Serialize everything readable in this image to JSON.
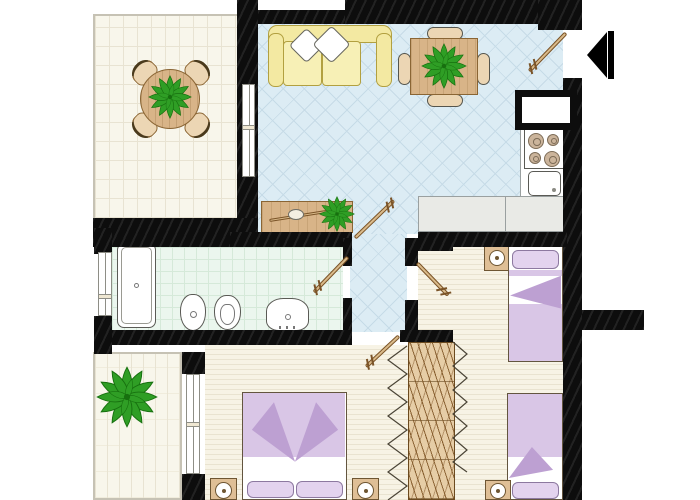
{
  "title": "Apartment floor plan (no text labels in drawing)",
  "palette": {
    "wall": "#0d0d0d",
    "livingFloor": "#dcecf4",
    "livingLine": "#c6dbe7",
    "tileFloor": "#f8f6eb",
    "tileLine": "#e8e3d2",
    "bathFloor": "#ebf6ee",
    "bathLine": "#d5e9d9",
    "woodFloor": "#f7f3e5",
    "woodLine": "#e9e3d0",
    "wood": "#d8b488",
    "woodDark": "#8a6534",
    "chairWood": "#ecd6b4",
    "sofa": "#f3e9a2",
    "sofaBorder": "#b2a040",
    "sofaCushion": "#f7f0b6",
    "bedFill": "#d9c6e6",
    "bedDark": "#bda0d2",
    "bedPillow": "#e3d3ee",
    "bedSheet": "#ffffff",
    "counter": "#e9eae6",
    "counterBorder": "#9aa0a0",
    "plantDark": "#17700f",
    "plantMid": "#2f9e25",
    "plantLight": "#54c23c",
    "leaf": "#d9ba8a",
    "leafBorder": "#7a5327",
    "fixture": "#ffffff",
    "fixtureBorder": "#5a5a55",
    "windowBorder": "#8e8e86"
  },
  "rooms": [
    {
      "id": "balcony-top",
      "name": "Balcony / terrace (top left)",
      "floor": "cream tile grid"
    },
    {
      "id": "living-room",
      "name": "Living room with open kitchen",
      "floor": "light blue diamond tile"
    },
    {
      "id": "hallway",
      "name": "Hallway",
      "floor": "light blue diamond tile"
    },
    {
      "id": "bathroom",
      "name": "Bathroom",
      "floor": "mint tile grid"
    },
    {
      "id": "bedroom-right",
      "name": "Bedroom with two single beds",
      "floor": "wood planks"
    },
    {
      "id": "bedroom-master",
      "name": "Master bedroom",
      "floor": "wood planks"
    },
    {
      "id": "balcony-bottom",
      "name": "Balcony (bottom left)",
      "floor": "cream tile"
    }
  ],
  "furniture": [
    {
      "name": "Round table with 4 chairs and plant"
    },
    {
      "name": "Yellow sofa with two white pillows"
    },
    {
      "name": "Square dining table with 4 chairs and plant"
    },
    {
      "name": "Wooden sideboard with decor object and plant"
    },
    {
      "name": "Cooktop with 4 burners"
    },
    {
      "name": "Kitchen sink"
    },
    {
      "name": "Kitchen counter"
    },
    {
      "name": "Bathtub / shower"
    },
    {
      "name": "Bidet"
    },
    {
      "name": "Toilet"
    },
    {
      "name": "Washbasin"
    },
    {
      "name": "Single bed (top)"
    },
    {
      "name": "Single bed (bottom)"
    },
    {
      "name": "Nightstand with lamp"
    },
    {
      "name": "Wardrobe with folding doors"
    },
    {
      "name": "Double bed with two pillows"
    },
    {
      "name": "Large potted plant"
    }
  ],
  "symbols": {
    "entrance_arrow": "Black arrow pointing left at entrance door (top right)",
    "door_count": 5,
    "window_count": 3,
    "wall_color": "#0d0d0d"
  }
}
